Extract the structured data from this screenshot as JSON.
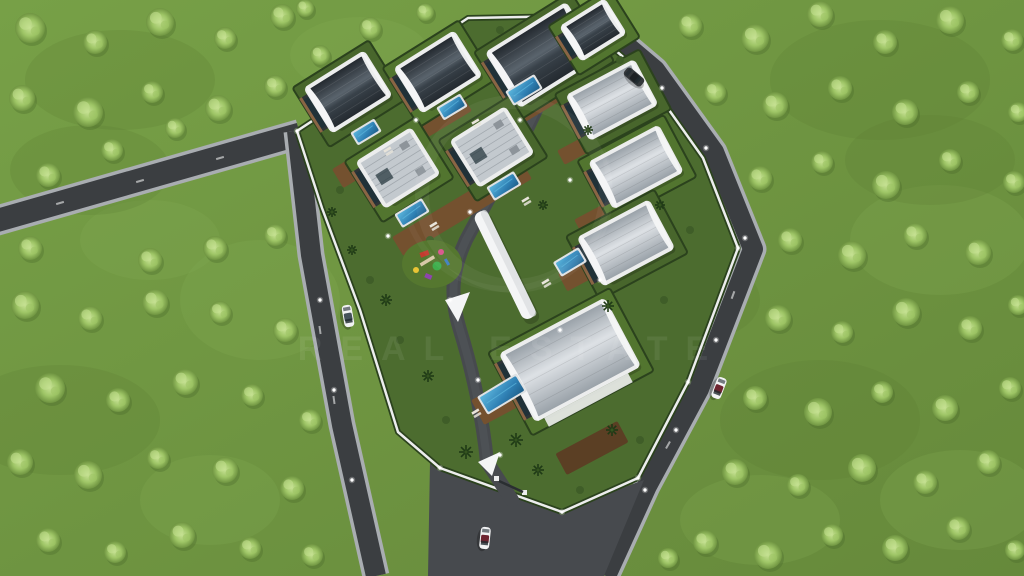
{
  "scene": {
    "type": "aerial-3d-architectural-render",
    "description": "Bird's-eye 3D visualization of a gated hillside villa complex: ten modern villas with curved barrel roofs and flat roofs, private pools, wooden decks, a children's playground, a white shade canopy walkway, perimeter roads with cars, all surrounded by green orchard fields dotted with trees",
    "watermark": {
      "text": "REAL ESTATE"
    }
  },
  "inventory": {
    "villas": 10,
    "pools": 7,
    "cars": 4,
    "playground": 1,
    "canopy_walkway": 1
  },
  "colors": {
    "grass": "#6f9441",
    "grass_light": "#85ad52",
    "grass_dark": "#597d33",
    "tree_core": "#c6e193",
    "tree_mid": "#9ec566",
    "tree_edge": "#6f9441",
    "tree_shadow": "#4a6b2c",
    "asphalt": "#3b3e41",
    "asphalt_light": "#474a4e",
    "curb": "#a9adb1",
    "lawn": "#4c6c2f",
    "lawn_alt": "#52752f",
    "hedge": "#2b421d",
    "wall": "#eceded",
    "roof_dark": "#242a30",
    "roof_dark_hi": "#5a646d",
    "roof_light": "#9aa2a9",
    "roof_light_hi": "#dde1e5",
    "facade": "#2e3437",
    "wood": "#8a6544",
    "glass": "#1f3138",
    "deck": "#74512f",
    "deck_dark": "#5b3f24",
    "pool": "#2f80b4",
    "pool_light": "#5cb6dd",
    "pool_dark": "#1f5f8a",
    "canopy": "#f4f5f6",
    "car_white": "#f2f3f4",
    "car_dark": "#34383b",
    "car_accent": "#6e2430",
    "lounger": "#e8e4da",
    "palm": "#1f3a16",
    "play_red": "#c23b2e",
    "play_green": "#3fae4c",
    "play_purple": "#8e44ad",
    "play_yellow": "#e9c435",
    "play_pink": "#d9538a",
    "play_path": "#d8c9a8"
  }
}
